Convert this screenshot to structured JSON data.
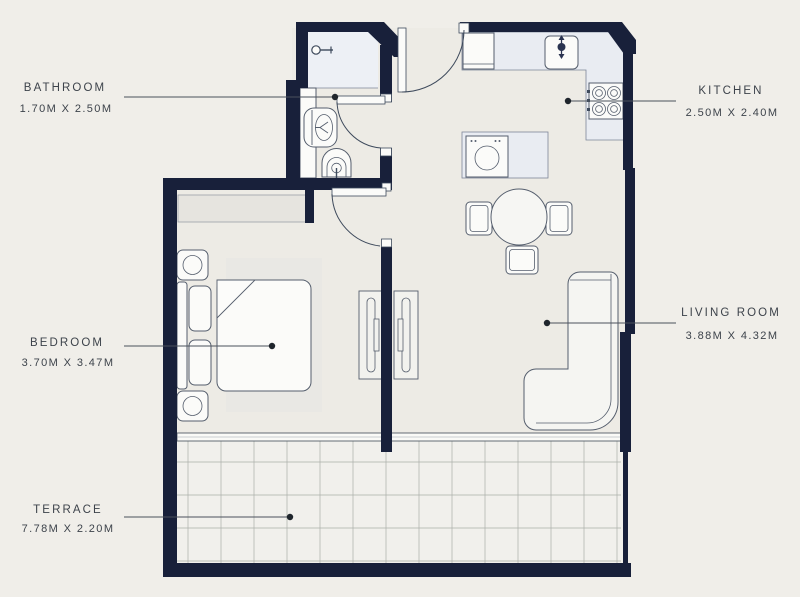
{
  "title": "Apartment Floor Plan",
  "colors": {
    "background": "#f0eee9",
    "interior_floor": "#edebe5",
    "terrace_floor": "#f1f0ec",
    "wall": "#18203a",
    "fixture_outline": "#555e6d",
    "counter_fill": "#e9ecf2",
    "shower_fill": "#edf0f5",
    "label_text": "#3d434b",
    "leader": "#4a515c"
  },
  "rooms": [
    {
      "id": "bathroom",
      "name": "BATHROOM",
      "dims": "1.70M X 2.50M"
    },
    {
      "id": "kitchen",
      "name": "KITCHEN",
      "dims": "2.50M X 2.40M"
    },
    {
      "id": "bedroom",
      "name": "BEDROOM",
      "dims": "3.70M X 3.47M"
    },
    {
      "id": "living-room",
      "name": "LIVING ROOM",
      "dims": "3.88M X 4.32M"
    },
    {
      "id": "terrace",
      "name": "TERRACE",
      "dims": "7.78M X 2.20M"
    }
  ],
  "fixtures": [
    "shower-icon",
    "toilet-icon",
    "washbasin-icon",
    "entry-door-icon",
    "fridge-icon",
    "kitchen-sink-icon",
    "stove-icon",
    "washing-machine-icon",
    "dining-table-icon",
    "chair-icon",
    "sofa-icon",
    "bed-icon",
    "pillow-icon",
    "nightstand-icon",
    "wardrobe-icon",
    "rug-icon",
    "bedroom-door-icon",
    "bathroom-door-icon",
    "window-icon",
    "terrace-tiles"
  ]
}
